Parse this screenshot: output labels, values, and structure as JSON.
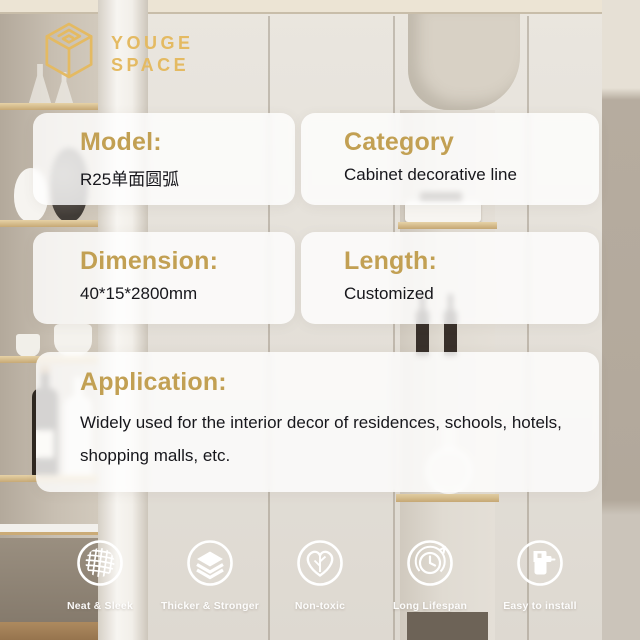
{
  "brand": {
    "line1": "YOUGE",
    "line2": "SPACE",
    "logo_icon": "cube-outline-icon"
  },
  "colors": {
    "brand_gold": "#e4ba62",
    "heading_gold": "#c2a053",
    "text_dark": "#17171c",
    "card_bg": "rgba(255,255,255,0.8)"
  },
  "specs": [
    {
      "id": "model",
      "label": "Model:",
      "value": "R25单面圆弧"
    },
    {
      "id": "category",
      "label": "Category",
      "value": "Cabinet decorative line"
    },
    {
      "id": "dimension",
      "label": "Dimension:",
      "value": "40*15*2800mm"
    },
    {
      "id": "length",
      "label": "Length:",
      "value": "Customized"
    }
  ],
  "application": {
    "label": "Application:",
    "value": "Widely used for the interior decor of residences, schools, hotels, shopping malls, etc."
  },
  "features": [
    {
      "label": "Neat & Sleek",
      "icon": "woven-mesh-icon"
    },
    {
      "label": "Thicker & Stronger",
      "icon": "stacked-layers-icon"
    },
    {
      "label": "Non-toxic",
      "icon": "heart-leaf-icon"
    },
    {
      "label": "Long Lifespan",
      "icon": "clock-cycle-icon"
    },
    {
      "label": "Easy to install",
      "icon": "glue-gun-icon"
    }
  ]
}
